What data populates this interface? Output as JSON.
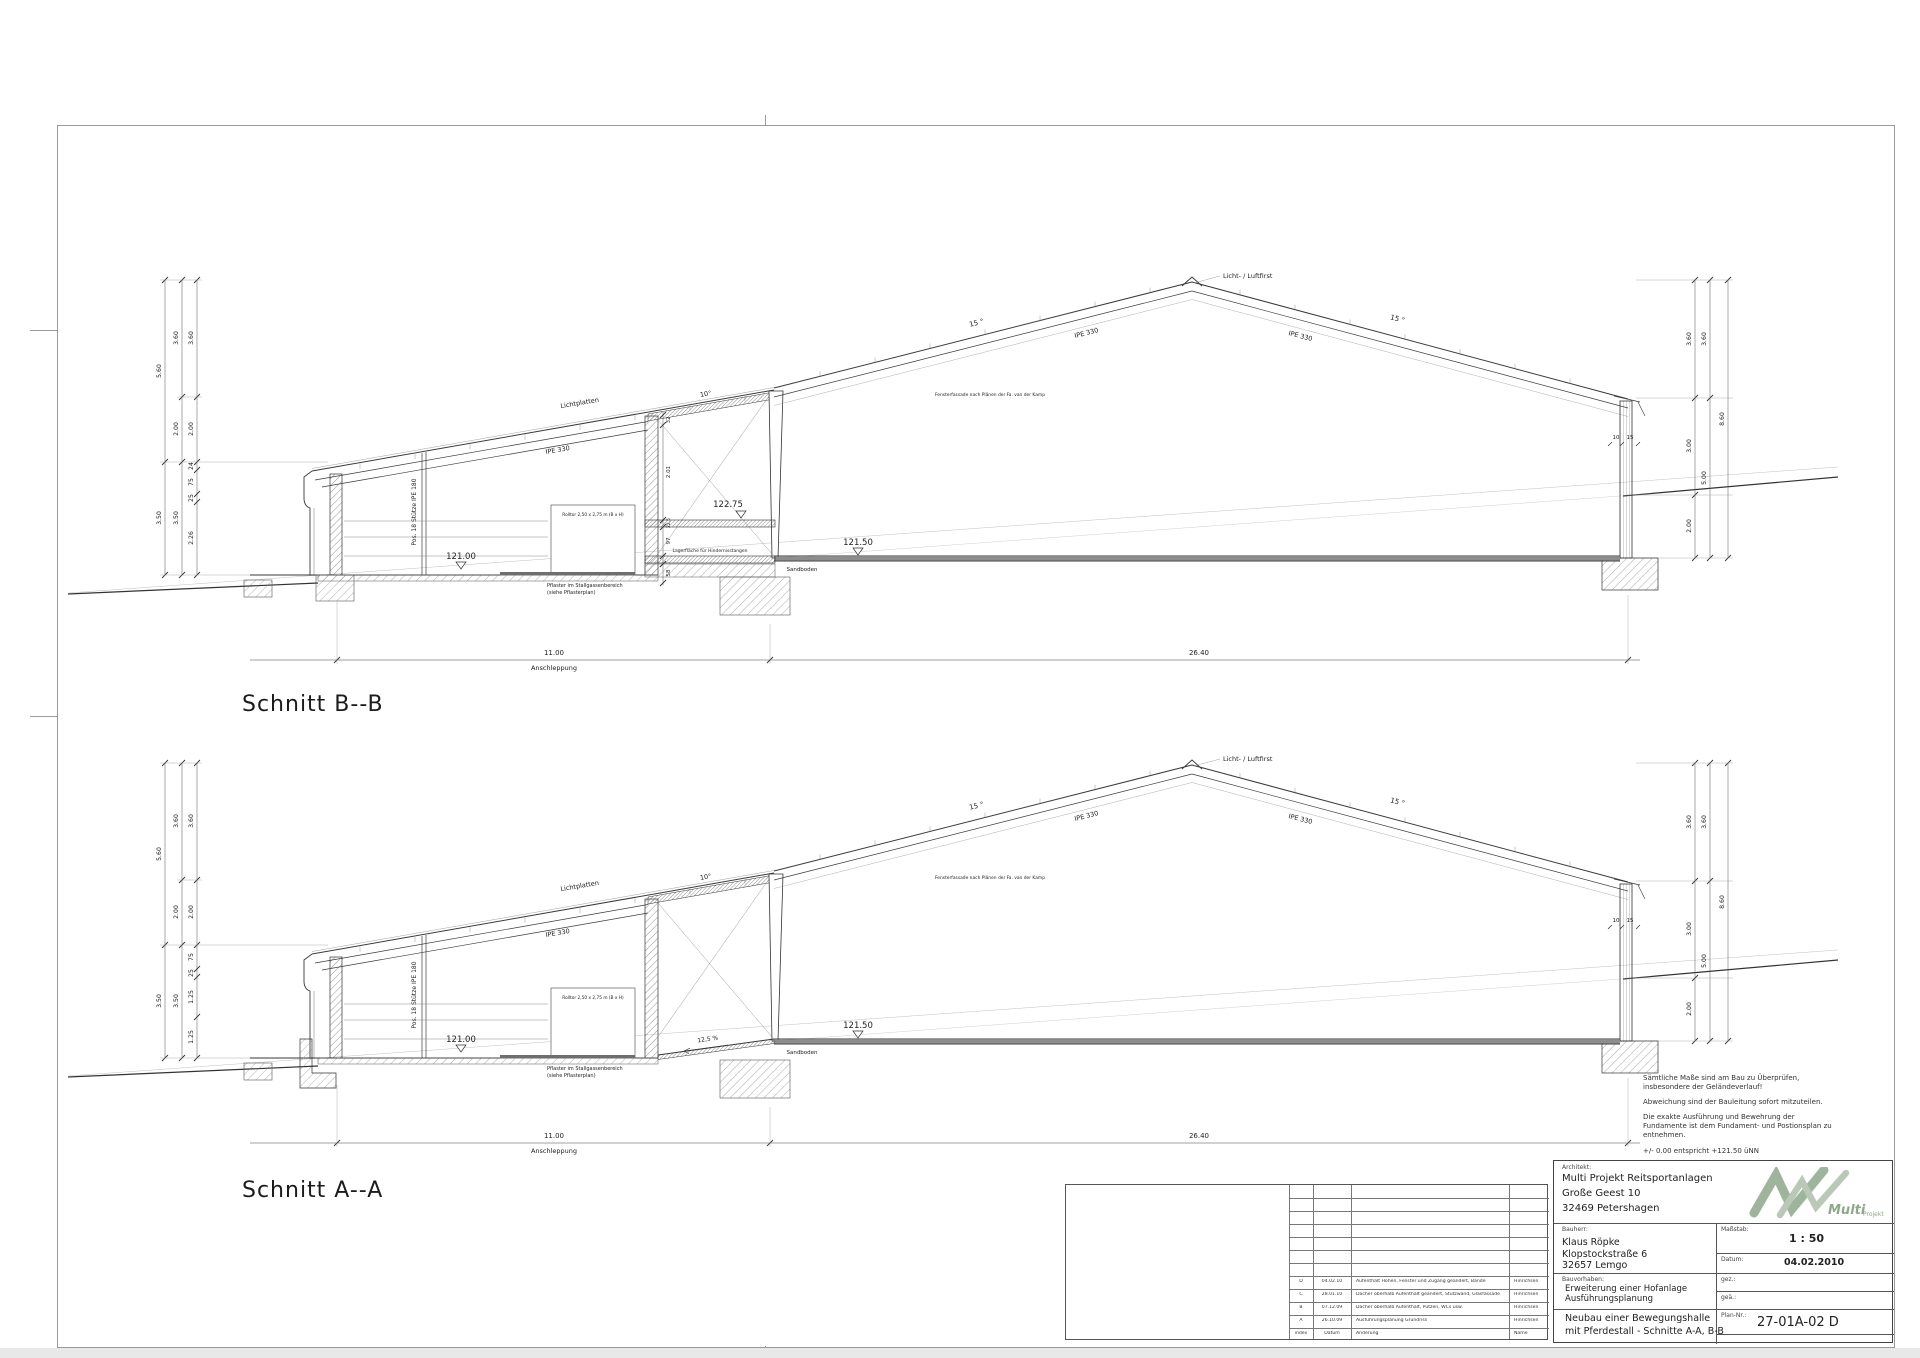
{
  "sections": [
    {
      "title": "Schnitt B--B",
      "variant": "corridor",
      "labels": {
        "lichtplatten": "Lichtplatten",
        "ipe_annex": "IPE 330",
        "angle_annex": "10°",
        "ridge": "Licht- / Luftfirst",
        "angle_left": "15 °",
        "angle_right": "15 °",
        "ipe_left": "IPE 330",
        "ipe_right": "IPE 330",
        "support": "Pos. 18 Stütze IPE 180",
        "rolltor": "Rolltor 2,50 x 2,75 m (B x H)",
        "fassade": "Fensterfassade nach Plänen der Fa. van der Kamp",
        "level_ground": "121.00",
        "level_hall": "121.50",
        "level_corridor": "122.75",
        "sandboden": "Sandboden",
        "pflaster_1": "Pflaster im Stallgassenbereich",
        "pflaster_2": "(siehe Pflasterplan)",
        "lager": "Lagerfläche für Hindernisstangen",
        "width_annex": "11.00",
        "anschleppung": "Anschleppung",
        "width_hall": "26.40",
        "eave_dim_1": "10",
        "eave_dim_2": "15"
      },
      "dims": {
        "left_outer": [
          "5.60",
          "3.50"
        ],
        "left_mid": [
          "3.60",
          "2.00",
          "3.50"
        ],
        "left_inner": [
          "3.60",
          "2.00",
          "24",
          "75",
          "25",
          "2.26"
        ],
        "right_inner": [
          "3.60",
          "3.00",
          "2.00"
        ],
        "right_mid": [
          "3.60",
          "5.00"
        ],
        "right_outer": [
          "8.60"
        ],
        "corridor": [
          "32",
          "2.01",
          "22,5",
          "97",
          "58"
        ]
      }
    },
    {
      "title": "Schnitt A--A",
      "variant": "ramp",
      "labels": {
        "lichtplatten": "Lichtplatten",
        "ipe_annex": "IPE 330",
        "angle_annex": "10°",
        "ridge": "Licht- / Luftfirst",
        "angle_left": "15 °",
        "angle_right": "15 °",
        "ipe_left": "IPE 330",
        "ipe_right": "IPE 330",
        "support": "Pos. 18 Stütze IPE 180",
        "rolltor": "Rolltor 2,50 x 2,75 m (B x H)",
        "fassade": "Fensterfassade nach Plänen der Fa. van der Kamp",
        "level_ground": "121.00",
        "level_hall": "121.50",
        "ramp": "12,5 %",
        "sandboden": "Sandboden",
        "pflaster_1": "Pflaster im Stallgassenbereich",
        "pflaster_2": "(siehe Pflasterplan)",
        "width_annex": "11.00",
        "anschleppung": "Anschleppung",
        "width_hall": "26.40",
        "eave_dim_1": "10",
        "eave_dim_2": "15"
      },
      "dims": {
        "left_outer": [
          "5.60",
          "3.50"
        ],
        "left_mid": [
          "3.60",
          "2.00",
          "3.50"
        ],
        "left_inner": [
          "3.60",
          "2.00",
          "75",
          "25",
          "1.25",
          "1.25"
        ],
        "right_inner": [
          "3.60",
          "3.00",
          "2.00"
        ],
        "right_mid": [
          "3.60",
          "5.00"
        ],
        "right_outer": [
          "8.60"
        ]
      }
    }
  ],
  "notes": {
    "p1": "Sämtliche Maße sind am Bau zu Überprüfen, insbesondere der Geländeverlauf!",
    "p2": "Abweichung sind der Bauleitung sofort mitzuteilen.",
    "p3": "Die exakte Ausführung und Bewehrung der Fundamente ist dem Fundament- und Postionsplan zu entnehmen.",
    "p4": "+/- 0.00  entspricht +121.50 üNN"
  },
  "revision_table": {
    "rows": [
      {
        "index": "D",
        "datum": "04.02.10",
        "aenderung": "Aufenthalt Höhen, Fenster und Zugang geändert, Bande",
        "name": "Hinrichsen"
      },
      {
        "index": "C",
        "datum": "28.01.10",
        "aenderung": "Dächer oberhalb Aufenthalt geändert, Stützwand, Glasfassade",
        "name": "Hinrichsen"
      },
      {
        "index": "B",
        "datum": "07.12.09",
        "aenderung": "Dächer oberhalb Aufenthalt, Putzen, WCs usw.",
        "name": "Hinrichsen"
      },
      {
        "index": "A",
        "datum": "26.10.09",
        "aenderung": "Ausführungsplanung Grundriss",
        "name": "Hinrichsen"
      },
      {
        "index": "index",
        "datum": "Datum",
        "aenderung": "Änderung",
        "name": "Name"
      }
    ]
  },
  "title_block": {
    "architect": {
      "label": "Architekt:",
      "line1": "Multi Projekt Reitsportanlagen",
      "line2": "Große Geest 10",
      "line3": "32469 Petershagen"
    },
    "logo": {
      "brand": "Multi",
      "suffix": "Projekt",
      "color": "#9fb49c"
    },
    "client": {
      "label": "Bauherr:",
      "line1": "Klaus Röpke",
      "line2": "Klopstockstraße 6",
      "line3": "32657 Lemgo"
    },
    "scale": {
      "label": "Maßstab:",
      "value": "1 : 50"
    },
    "date": {
      "label": "Datum:",
      "value": "04.02.2010"
    },
    "project": {
      "label": "Bauvorhaben:",
      "line1": "Erweiterung einer Hofanlage",
      "line2": "Ausführungsplanung"
    },
    "gez": {
      "label": "gez.:",
      "value": ""
    },
    "gea": {
      "label": "geä.:",
      "value": ""
    },
    "title": {
      "line1": "Neubau einer Bewegungshalle",
      "line2": "mit Pferdestall - Schnitte A-A, B-B"
    },
    "plan_no": {
      "label": "Plan-Nr.:",
      "value": "27-01A-02 D"
    }
  }
}
